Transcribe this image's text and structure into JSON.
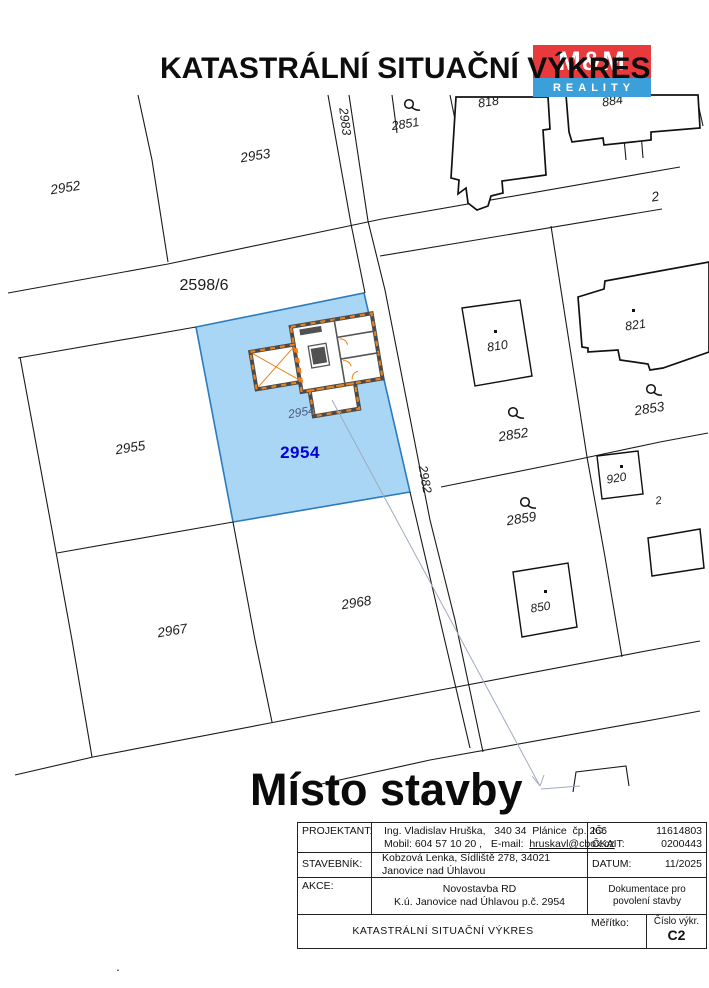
{
  "header": {
    "title": "KATASTRÁLNÍ SITUAČNÍ VÝKRES"
  },
  "logo": {
    "top": "M&M",
    "bottom": "REALITY"
  },
  "map": {
    "site_label": "Místo stavby",
    "labels": {
      "p2952": "2952",
      "p2953": "2953",
      "p2983": "2983",
      "p2851": "2851",
      "p818": "818",
      "p884": "884",
      "p2598": "2598/6",
      "p810": "810",
      "p821": "821",
      "p2852": "2852",
      "p2853": "2853",
      "p2955": "2955",
      "p2954": "2954",
      "p2954_building": "2954",
      "p2982": "2982",
      "p920": "920",
      "p2859": "2859",
      "p2968": "2968",
      "p850": "850",
      "p2967": "2967",
      "edge_top": "2",
      "edge_mid": "2",
      "footnote_dot": "."
    },
    "colors": {
      "parcel_highlight_fill": "#a9d6f4",
      "parcel_highlight_stroke": "#2b7bbf",
      "parcel_number_highlight": "#0000d2",
      "wall_accent": "#e8821e",
      "logo_red": "#e8393c",
      "logo_blue": "#3ba0d9"
    }
  },
  "titleblock": {
    "projektant_label": "PROJEKTANT:",
    "projektant_line1": "Ing. Vladislav Hruška,   340 34  Plánice  čp. 266",
    "projektant_line2": "Mobil: 604 57 10 20 ,   E-mail:  ",
    "email": "hruskavl@cbox.cz",
    "ic_label": "IČ:",
    "ic": "11614803",
    "ckait_label": "ČKAIT:",
    "ckait": "0200443",
    "stavebnik_label": "STAVEBNÍK:",
    "stavebnik": "Kobzová Lenka, Sídliště 278, 34021 Janovice nad Úhlavou",
    "datum_label": "DATUM:",
    "datum": "11/2025",
    "akce_label": "AKCE:",
    "akce_line1": "Novostavba RD",
    "akce_line2": "K.ú. Janovice nad Úhlavou p.č. 2954",
    "dok_line1": "Dokumentace pro",
    "dok_line2": "povolení stavby",
    "drawing_title": "KATASTRÁLNÍ SITUAČNÍ VÝKRES",
    "meritko_label": "Měřítko:",
    "cislo_label": "Číslo výkr.",
    "cislo": "C2"
  }
}
